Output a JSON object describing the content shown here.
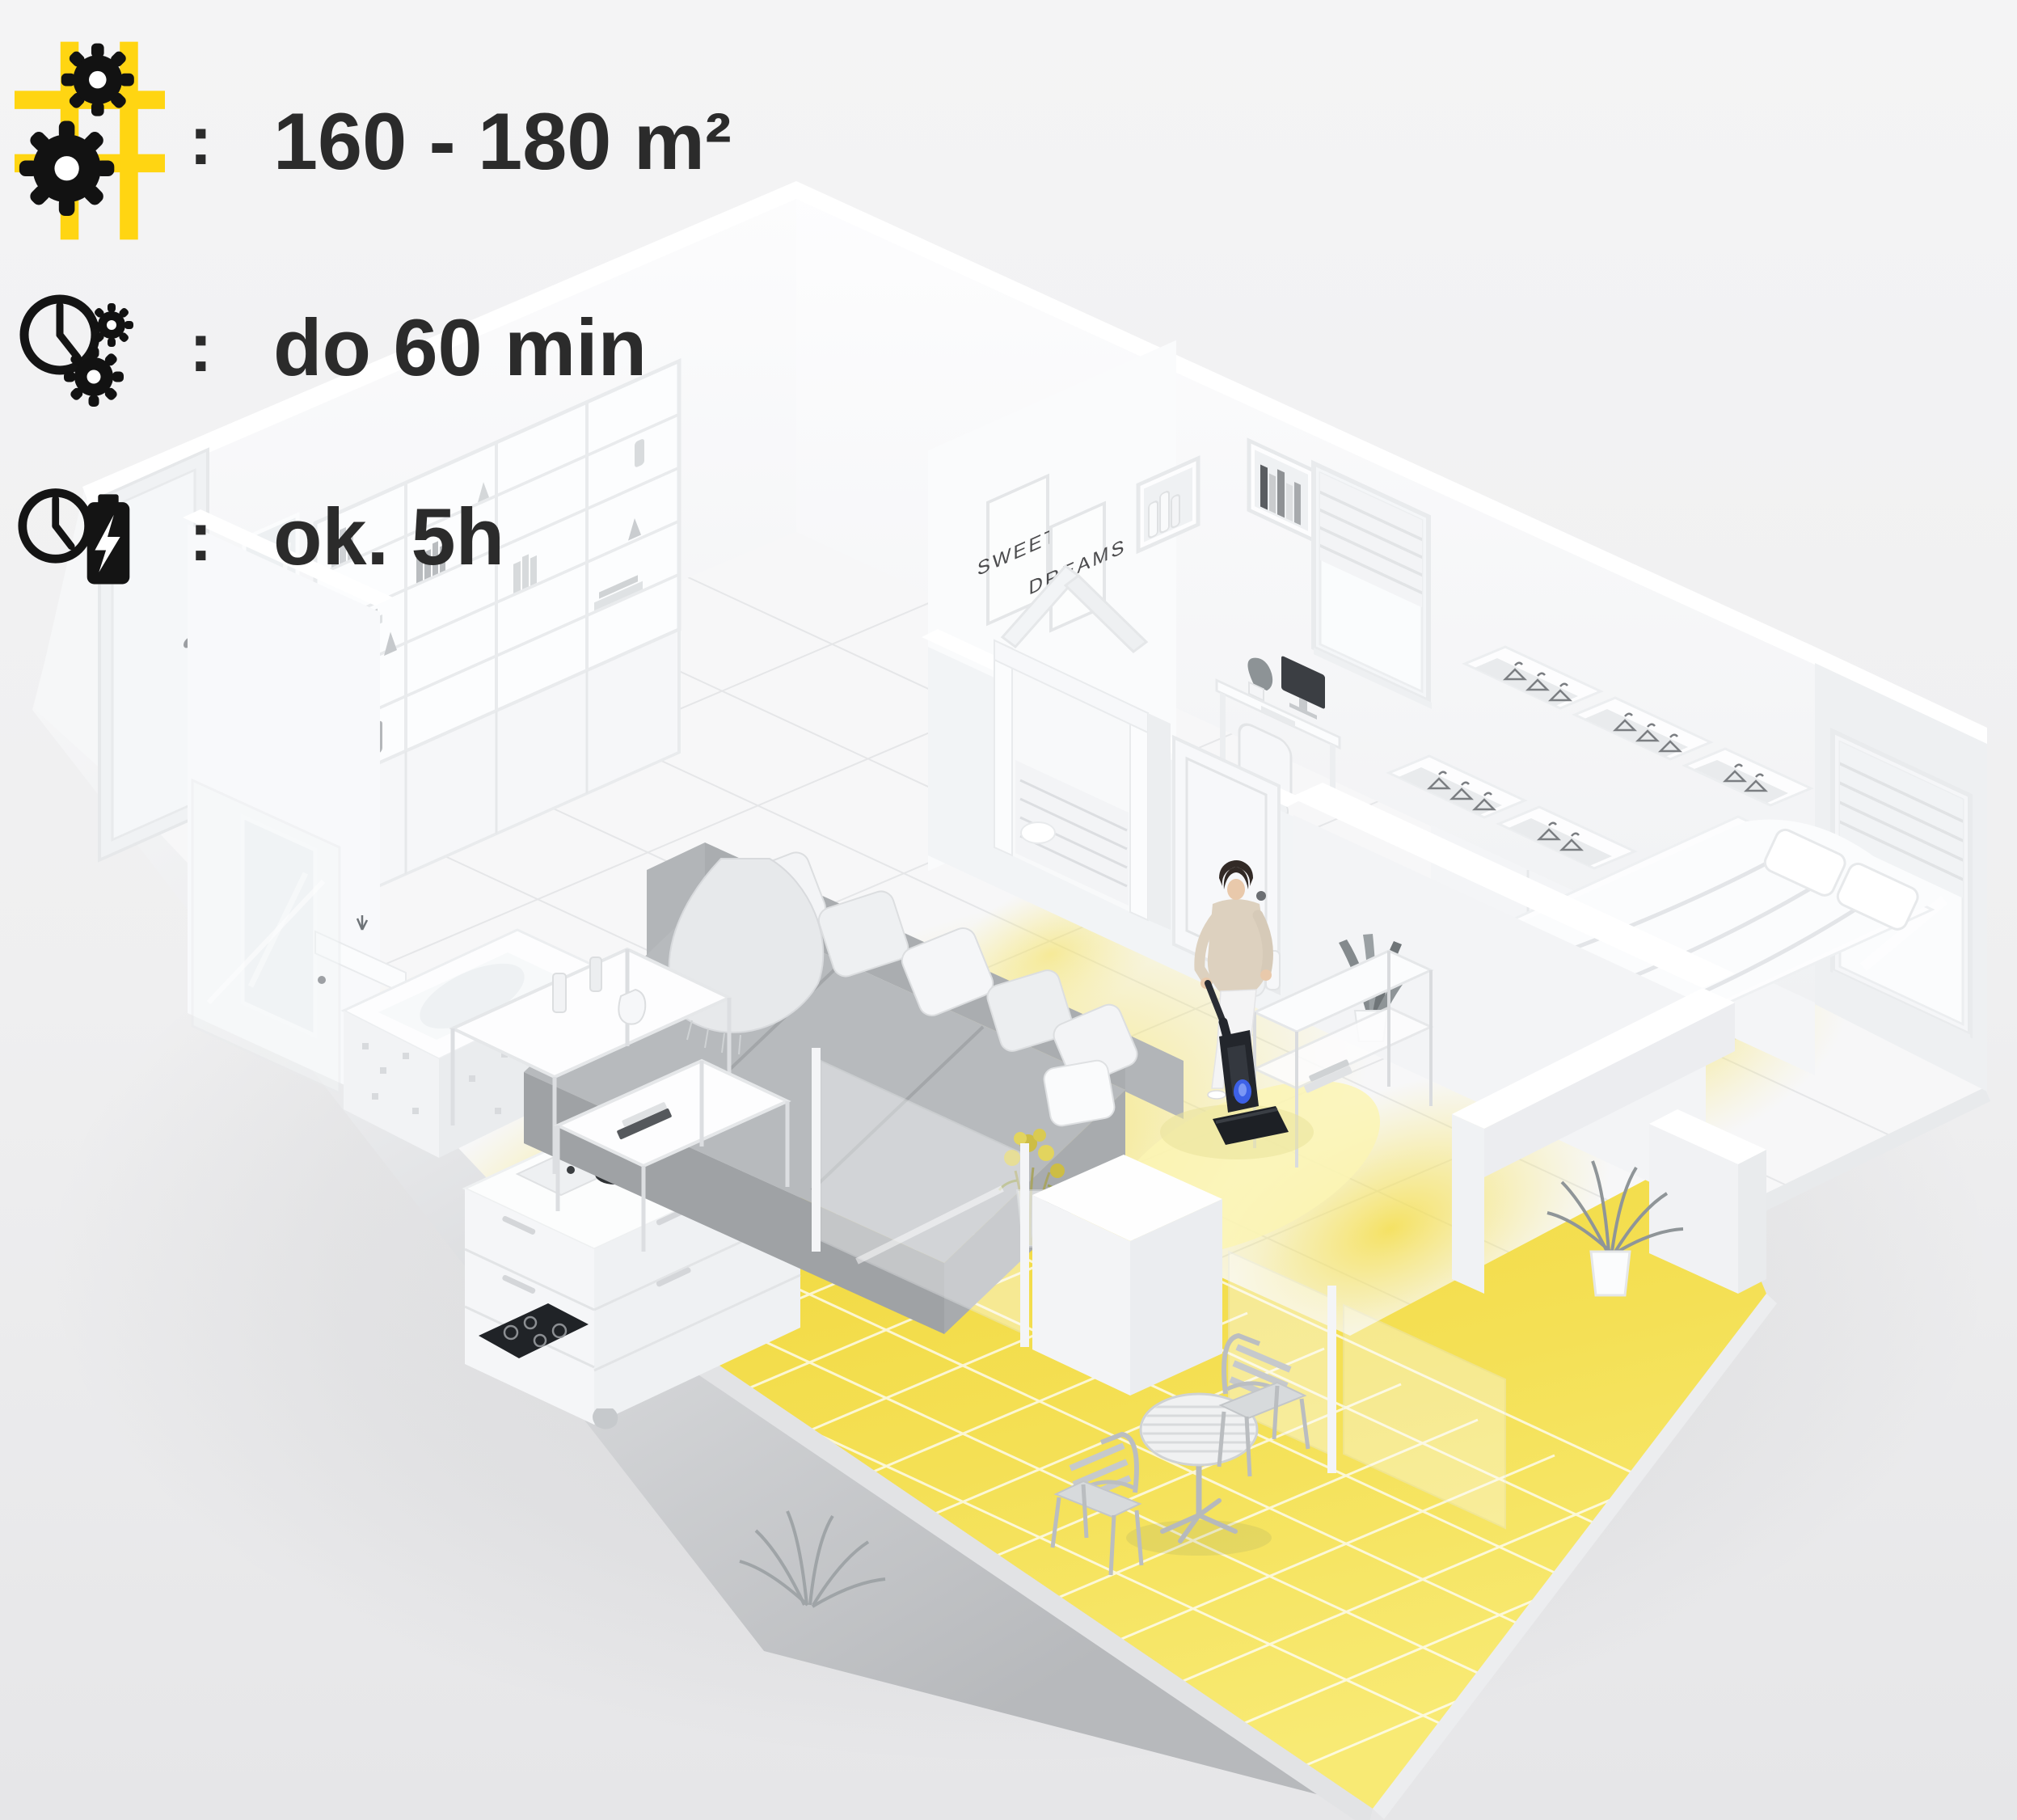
{
  "specs": {
    "rows": [
      {
        "icon": "floor-grid-gears-icon",
        "separator": ":",
        "value": "160 - 180 m²"
      },
      {
        "icon": "clock-gears-icon",
        "separator": ":",
        "value": "do 60 min"
      },
      {
        "icon": "clock-battery-icon",
        "separator": ":",
        "value": "ok. 5h"
      }
    ]
  },
  "scene": {
    "wall_posters": {
      "left": "SWEET",
      "right": "DREAMS"
    }
  },
  "colors": {
    "accent-yellow": "#FFD512",
    "floor-glow-yellow": "#F6E14B",
    "balcony-tile-yellow": "#F2DA3E",
    "text-dark": "#2B2B2B",
    "vacuum-glow-blue": "#3E63F0"
  }
}
